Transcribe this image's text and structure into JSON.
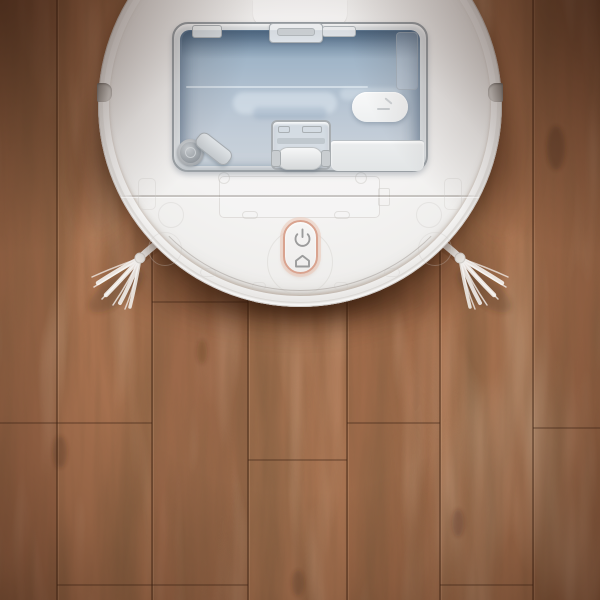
{
  "scene": {
    "description": "Top-down photograph of a white robot vacuum cleaner with mop function standing on a brown hardwood plank floor",
    "device_type": "robot vacuum / mop",
    "floor_type": "hardwood planks, vertical grain",
    "has_text": false
  },
  "device": {
    "body": "round white robot body, top view, upper edge cropped by image border",
    "tank": "translucent blue-grey water tank / dustbin window with clear latches",
    "controls": [
      {
        "name": "power-button",
        "icon": "power-icon"
      },
      {
        "name": "home-button",
        "icon": "home-icon"
      }
    ],
    "parts": [
      "tank-latch",
      "tank-side-latch",
      "filter-cap",
      "float-handle",
      "mop-roller",
      "roller-housing",
      "white-reservoir-block",
      "left-side-brush",
      "right-side-brush",
      "rim-notch-left",
      "rim-notch-right",
      "cover-seam-line",
      "maintenance-plate-outline"
    ]
  },
  "colors": {
    "floor_base": "#a5704f",
    "floor_seam": "#5f3c28",
    "robot_body": "#f4f3f2",
    "tank_blue": "#b3c2d1",
    "tank_blue_deep": "#8aa2b9",
    "accent_ring": "#d9a38f",
    "icon_gray": "#9c9c9c",
    "shadow": "rgba(50,24,10,0.5)"
  }
}
